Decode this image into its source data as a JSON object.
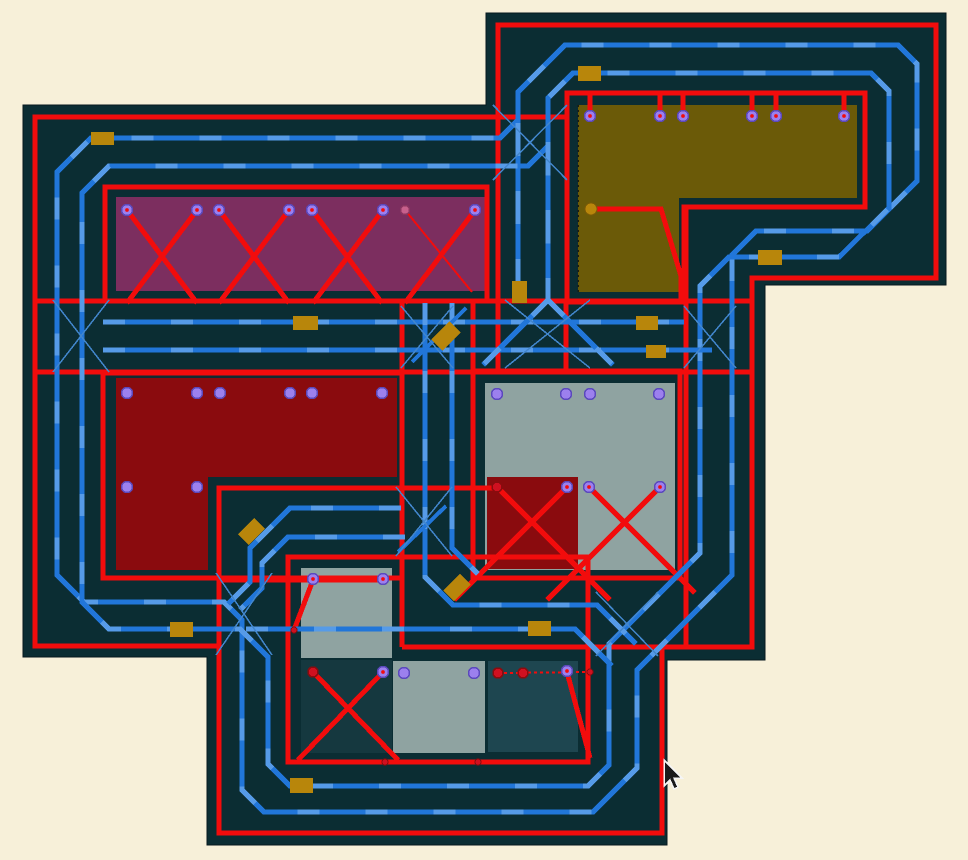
{
  "canvas": {
    "width": 968,
    "height": 860
  },
  "colors": {
    "background": "#f7f0d9",
    "board": "#0b2d33",
    "red": "#f20c0c",
    "blue": "#2176d9",
    "blue_light": "#5fa2ea",
    "blue_thin": "#4286cc",
    "gold": "#b8860b",
    "violet_pad": "#9c80ee",
    "violet_ring": "#5b49bd",
    "red_pad": "#d01020",
    "red_pad_ring": "#8a0b0e",
    "pink_pad": "#c7608c",
    "cursor_fill": "#1a1a1a",
    "cursor_edge": "#f5f5f5"
  },
  "board_outline": [
    [
      23,
      105
    ],
    [
      486,
      105
    ],
    [
      486,
      13
    ],
    [
      946,
      13
    ],
    [
      946,
      285
    ],
    [
      765,
      285
    ],
    [
      765,
      660
    ],
    [
      667,
      660
    ],
    [
      667,
      845
    ],
    [
      207,
      845
    ],
    [
      207,
      657
    ],
    [
      23,
      657
    ]
  ],
  "zones": [
    {
      "name": "zone-purple",
      "color": "#7c2e5f",
      "points": [
        [
          116,
          197
        ],
        [
          486,
          197
        ],
        [
          486,
          291
        ],
        [
          116,
          291
        ]
      ]
    },
    {
      "name": "zone-olive",
      "color": "#6b5a08",
      "points": [
        [
          578,
          105
        ],
        [
          857,
          105
        ],
        [
          857,
          198
        ],
        [
          679,
          198
        ],
        [
          679,
          292
        ],
        [
          578,
          292
        ]
      ],
      "dotted_edge": [
        [
          578,
          105
        ],
        [
          578,
          292
        ]
      ]
    },
    {
      "name": "zone-darkred",
      "color": "#8a0b0e",
      "points": [
        [
          116,
          378
        ],
        [
          397,
          378
        ],
        [
          397,
          477
        ],
        [
          208,
          477
        ],
        [
          208,
          570
        ],
        [
          116,
          570
        ]
      ]
    },
    {
      "name": "zone-gray",
      "color": "#8fa3a1",
      "points": [
        [
          485,
          383
        ],
        [
          675,
          383
        ],
        [
          675,
          570
        ],
        [
          485,
          570
        ]
      ]
    },
    {
      "name": "zone-darkred-sub",
      "color": "#8a0b0e",
      "points": [
        [
          487,
          477
        ],
        [
          578,
          477
        ],
        [
          578,
          569
        ],
        [
          487,
          569
        ]
      ]
    },
    {
      "name": "zone-gray-small",
      "color": "#8fa3a1",
      "points": [
        [
          301,
          568
        ],
        [
          392,
          568
        ],
        [
          392,
          658
        ],
        [
          301,
          658
        ]
      ]
    },
    {
      "name": "zone-teal-a",
      "color": "#15383f",
      "points": [
        [
          301,
          660
        ],
        [
          392,
          660
        ],
        [
          392,
          753
        ],
        [
          301,
          753
        ]
      ]
    },
    {
      "name": "zone-gray-b",
      "color": "#8fa3a1",
      "points": [
        [
          393,
          661
        ],
        [
          485,
          661
        ],
        [
          485,
          753
        ],
        [
          393,
          753
        ]
      ]
    },
    {
      "name": "zone-teal-c",
      "color": "#1e4650",
      "points": [
        [
          488,
          661
        ],
        [
          578,
          661
        ],
        [
          578,
          752
        ],
        [
          488,
          752
        ]
      ]
    }
  ],
  "red_traces": [
    {
      "points": [
        [
          567,
          117
        ],
        [
          35,
          117
        ],
        [
          35,
          646
        ],
        [
          218,
          646
        ]
      ]
    },
    {
      "points": [
        [
          497,
          488
        ],
        [
          219,
          488
        ],
        [
          219,
          833
        ],
        [
          662,
          833
        ],
        [
          662,
          647
        ],
        [
          752,
          647
        ],
        [
          752,
          278
        ],
        [
          936,
          278
        ],
        [
          936,
          25
        ],
        [
          498,
          25
        ],
        [
          498,
          372
        ]
      ]
    },
    {
      "points": [
        [
          35,
          301
        ],
        [
          752,
          301
        ]
      ]
    },
    {
      "points": [
        [
          35,
          372
        ],
        [
          752,
          372
        ]
      ]
    },
    {
      "points": [
        [
          105,
          187
        ],
        [
          487,
          187
        ],
        [
          487,
          301
        ],
        [
          105,
          301
        ]
      ],
      "closed": true
    },
    {
      "points": [
        [
          567,
          93
        ],
        [
          865,
          93
        ],
        [
          865,
          207
        ],
        [
          684,
          207
        ],
        [
          684,
          302
        ],
        [
          567,
          302
        ]
      ],
      "closed": true
    },
    {
      "points": [
        [
          103,
          373
        ],
        [
          402,
          373
        ],
        [
          402,
          578
        ],
        [
          103,
          578
        ]
      ],
      "closed": true
    },
    {
      "points": [
        [
          473,
          371
        ],
        [
          680,
          371
        ],
        [
          680,
          578
        ],
        [
          473,
          578
        ]
      ],
      "closed": true
    },
    {
      "points": [
        [
          473,
          301
        ],
        [
          473,
          371
        ]
      ]
    },
    {
      "points": [
        [
          288,
          557
        ],
        [
          588,
          557
        ],
        [
          588,
          762
        ],
        [
          288,
          762
        ]
      ],
      "closed": true
    },
    {
      "points": [
        [
          219,
          580
        ],
        [
          383,
          580
        ]
      ]
    },
    {
      "points": [
        [
          313,
          580
        ],
        [
          294,
          630
        ]
      ]
    },
    {
      "points": [
        [
          590,
          94
        ],
        [
          590,
          116
        ]
      ]
    },
    {
      "points": [
        [
          660,
          94
        ],
        [
          660,
          116
        ]
      ]
    },
    {
      "points": [
        [
          683,
          94
        ],
        [
          683,
          116
        ]
      ]
    },
    {
      "points": [
        [
          752,
          94
        ],
        [
          752,
          116
        ]
      ]
    },
    {
      "points": [
        [
          776,
          94
        ],
        [
          776,
          116
        ]
      ]
    },
    {
      "points": [
        [
          844,
          94
        ],
        [
          844,
          116
        ]
      ]
    },
    {
      "points": [
        [
          591,
          209
        ],
        [
          661,
          209
        ],
        [
          681,
          276
        ],
        [
          681,
          302
        ]
      ]
    },
    {
      "points": [
        [
          566,
          302
        ],
        [
          566,
          371
        ]
      ]
    },
    {
      "points": [
        [
          686,
          207
        ],
        [
          686,
          647
        ]
      ]
    },
    {
      "points": [
        [
          402,
          301
        ],
        [
          402,
          647
        ]
      ]
    },
    {
      "points": [
        [
          402,
          647
        ],
        [
          662,
          647
        ]
      ]
    },
    {
      "points": [
        [
          127,
          210
        ],
        [
          197,
          303
        ]
      ]
    },
    {
      "points": [
        [
          197,
          210
        ],
        [
          127,
          303
        ]
      ]
    },
    {
      "points": [
        [
          219,
          210
        ],
        [
          289,
          303
        ]
      ]
    },
    {
      "points": [
        [
          289,
          210
        ],
        [
          219,
          303
        ]
      ]
    },
    {
      "points": [
        [
          312,
          210
        ],
        [
          382,
          303
        ]
      ]
    },
    {
      "points": [
        [
          383,
          210
        ],
        [
          313,
          303
        ]
      ]
    },
    {
      "points": [
        [
          475,
          210
        ],
        [
          405,
          303
        ]
      ]
    },
    {
      "points": [
        [
          405,
          210
        ],
        [
          472,
          292
        ]
      ],
      "width": 2
    },
    {
      "points": [
        [
          497,
          487
        ],
        [
          610,
          600
        ]
      ]
    },
    {
      "points": [
        [
          567,
          487
        ],
        [
          454,
          600
        ]
      ]
    },
    {
      "points": [
        [
          589,
          487
        ],
        [
          695,
          593
        ]
      ]
    },
    {
      "points": [
        [
          660,
          487
        ],
        [
          547,
          600
        ]
      ]
    },
    {
      "points": [
        [
          313,
          672
        ],
        [
          398,
          760
        ]
      ]
    },
    {
      "points": [
        [
          383,
          672
        ],
        [
          298,
          760
        ]
      ]
    },
    {
      "points": [
        [
          567,
          672
        ],
        [
          590,
          758
        ]
      ]
    },
    {
      "points": [
        [
          498,
          673
        ],
        [
          592,
          672
        ]
      ],
      "width": 2,
      "dash": "3 3"
    }
  ],
  "blue_traces": [
    {
      "points": [
        [
          518,
          281
        ],
        [
          518,
          92
        ],
        [
          565,
          45
        ],
        [
          898,
          45
        ],
        [
          917,
          64
        ],
        [
          917,
          181
        ],
        [
          867,
          231
        ],
        [
          756,
          231
        ],
        [
          732,
          255
        ],
        [
          732,
          575
        ],
        [
          637,
          670
        ],
        [
          637,
          768
        ],
        [
          593,
          812
        ],
        [
          264,
          812
        ],
        [
          242,
          790
        ],
        [
          242,
          620
        ],
        [
          224,
          602
        ],
        [
          84,
          602
        ],
        [
          57,
          575
        ],
        [
          57,
          172
        ],
        [
          91,
          138
        ],
        [
          500,
          138
        ],
        [
          518,
          120
        ]
      ],
      "closed": true
    },
    {
      "points": [
        [
          548,
          300
        ],
        [
          548,
          98
        ],
        [
          573,
          73
        ],
        [
          871,
          73
        ],
        [
          889,
          91
        ],
        [
          889,
          208
        ],
        [
          839,
          257
        ],
        [
          729,
          257
        ],
        [
          700,
          286
        ],
        [
          700,
          553
        ],
        [
          609,
          644
        ],
        [
          609,
          765
        ],
        [
          588,
          786
        ],
        [
          290,
          786
        ],
        [
          268,
          764
        ],
        [
          268,
          657
        ],
        [
          240,
          629
        ],
        [
          109,
          629
        ],
        [
          82,
          602
        ],
        [
          82,
          193
        ],
        [
          109,
          166
        ],
        [
          528,
          166
        ],
        [
          548,
          146
        ]
      ],
      "closed": true
    },
    {
      "points": [
        [
          103,
          322
        ],
        [
          684,
          322
        ]
      ]
    },
    {
      "points": [
        [
          103,
          350
        ],
        [
          712,
          350
        ]
      ]
    },
    {
      "points": [
        [
          425,
          303
        ],
        [
          425,
          577
        ],
        [
          453,
          605
        ],
        [
          597,
          605
        ],
        [
          636,
          644
        ]
      ]
    },
    {
      "points": [
        [
          452,
          303
        ],
        [
          452,
          548
        ],
        [
          478,
          574
        ]
      ]
    },
    {
      "points": [
        [
          246,
          629
        ],
        [
          575,
          629
        ],
        [
          612,
          666
        ]
      ]
    },
    {
      "points": [
        [
          401,
          508
        ],
        [
          290,
          508
        ],
        [
          250,
          548
        ],
        [
          250,
          582
        ],
        [
          228,
          604
        ]
      ]
    },
    {
      "points": [
        [
          405,
          537
        ],
        [
          288,
          537
        ],
        [
          262,
          563
        ],
        [
          262,
          588
        ],
        [
          240,
          610
        ]
      ]
    },
    {
      "points": [
        [
          548,
          300
        ],
        [
          483,
          365
        ]
      ]
    },
    {
      "points": [
        [
          548,
          300
        ],
        [
          613,
          365
        ]
      ]
    },
    {
      "points": [
        [
          412,
          362
        ],
        [
          466,
          308
        ]
      ],
      "width": 4
    },
    {
      "points": [
        [
          398,
          552
        ],
        [
          446,
          506
        ]
      ],
      "width": 4
    }
  ],
  "crossings": [
    [
      53,
      300,
      109,
      372
    ],
    [
      493,
      105,
      567,
      180
    ],
    [
      401,
      306,
      453,
      368
    ],
    [
      684,
      306,
      736,
      368
    ],
    [
      216,
      573,
      272,
      655
    ],
    [
      596,
      592,
      658,
      656
    ],
    [
      396,
      487,
      452,
      556
    ],
    [
      505,
      300,
      590,
      368
    ]
  ],
  "components": [
    {
      "x": 91,
      "y": 132,
      "w": 23,
      "h": 13,
      "rot": 0
    },
    {
      "x": 293,
      "y": 316,
      "w": 25,
      "h": 14,
      "rot": 0
    },
    {
      "x": 512,
      "y": 281,
      "w": 15,
      "h": 22,
      "rot": 0
    },
    {
      "x": 433,
      "y": 328,
      "w": 26,
      "h": 16,
      "rot": -45
    },
    {
      "x": 636,
      "y": 316,
      "w": 22,
      "h": 14,
      "rot": 0
    },
    {
      "x": 646,
      "y": 345,
      "w": 20,
      "h": 13,
      "rot": 0
    },
    {
      "x": 240,
      "y": 524,
      "w": 23,
      "h": 15,
      "rot": -45
    },
    {
      "x": 445,
      "y": 580,
      "w": 24,
      "h": 15,
      "rot": -45
    },
    {
      "x": 528,
      "y": 621,
      "w": 23,
      "h": 15,
      "rot": 0
    },
    {
      "x": 170,
      "y": 622,
      "w": 23,
      "h": 15,
      "rot": 0
    },
    {
      "x": 290,
      "y": 778,
      "w": 23,
      "h": 15,
      "rot": 0
    },
    {
      "x": 758,
      "y": 250,
      "w": 24,
      "h": 15,
      "rot": 0
    },
    {
      "x": 578,
      "y": 66,
      "w": 23,
      "h": 15,
      "rot": 0
    }
  ],
  "pads": {
    "violet": [
      [
        127,
        210
      ],
      [
        197,
        210
      ],
      [
        219,
        210
      ],
      [
        289,
        210
      ],
      [
        312,
        210
      ],
      [
        383,
        210
      ],
      [
        475,
        210
      ],
      [
        590,
        116
      ],
      [
        660,
        116
      ],
      [
        683,
        116
      ],
      [
        752,
        116
      ],
      [
        776,
        116
      ],
      [
        844,
        116
      ],
      [
        127,
        393
      ],
      [
        197,
        393
      ],
      [
        220,
        393
      ],
      [
        290,
        393
      ],
      [
        312,
        393
      ],
      [
        382,
        393
      ],
      [
        127,
        487
      ],
      [
        197,
        487
      ],
      [
        497,
        394
      ],
      [
        566,
        394
      ],
      [
        590,
        394
      ],
      [
        659,
        394
      ],
      [
        567,
        487
      ],
      [
        589,
        487
      ],
      [
        660,
        487
      ],
      [
        313,
        579
      ],
      [
        383,
        579
      ],
      [
        383,
        672
      ],
      [
        404,
        673
      ],
      [
        474,
        673
      ],
      [
        567,
        671
      ]
    ],
    "pink": [
      [
        405,
        210
      ]
    ],
    "gold": [
      [
        591,
        209
      ]
    ],
    "red": [
      [
        497,
        487
      ],
      [
        313,
        672
      ],
      [
        498,
        673
      ],
      [
        523,
        673
      ]
    ],
    "center_dots": [
      [
        127,
        210
      ],
      [
        197,
        210
      ],
      [
        219,
        210
      ],
      [
        289,
        210
      ],
      [
        312,
        210
      ],
      [
        383,
        210
      ],
      [
        475,
        210
      ],
      [
        590,
        116
      ],
      [
        660,
        116
      ],
      [
        683,
        116
      ],
      [
        752,
        116
      ],
      [
        776,
        116
      ],
      [
        844,
        116
      ],
      [
        567,
        487
      ],
      [
        589,
        487
      ],
      [
        660,
        487
      ],
      [
        313,
        579
      ],
      [
        383,
        579
      ],
      [
        383,
        672
      ],
      [
        567,
        671
      ]
    ],
    "loose_dots": [
      [
        385,
        762
      ],
      [
        478,
        762
      ],
      [
        294,
        630
      ],
      [
        590,
        672
      ]
    ]
  },
  "cursor": {
    "x": 664,
    "y": 760
  }
}
